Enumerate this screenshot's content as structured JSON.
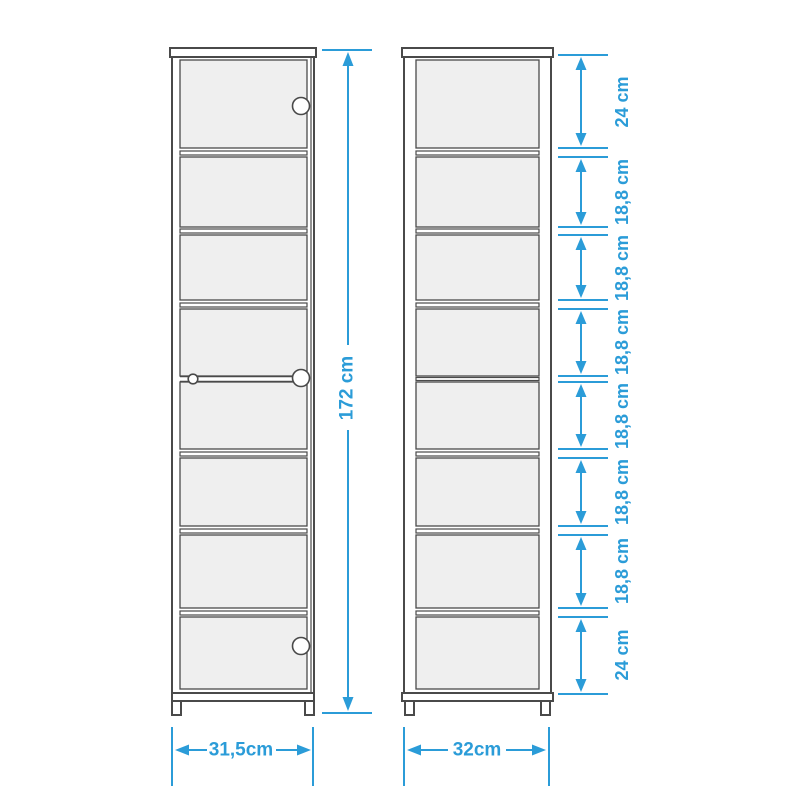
{
  "colors": {
    "accent": "#2B9CD8",
    "line": "#4A4A4A",
    "panel_fill": "#EFEFEF",
    "background": "#FFFFFF"
  },
  "labels": {
    "height": "172 cm",
    "left_width": "31,5cm",
    "right_width": "32cm",
    "segments": [
      "24 cm",
      "18,8 cm",
      "18,8 cm",
      "18,8 cm",
      "18,8 cm",
      "18,8 cm",
      "18,8 cm",
      "24 cm"
    ]
  },
  "measurements": {
    "height_cm": 172,
    "left_width_cm": 31.5,
    "right_width_cm": 32,
    "shelf_segments_cm": [
      24,
      18.8,
      18.8,
      18.8,
      18.8,
      18.8,
      18.8,
      24
    ]
  },
  "cabinets": {
    "left": {
      "view": "front elevation, tall cabinet with door",
      "knob_count": 3,
      "compartment_count": 8
    },
    "right": {
      "view": "front elevation, open shelf unit",
      "compartment_count": 8,
      "shelf_count": 7
    }
  }
}
